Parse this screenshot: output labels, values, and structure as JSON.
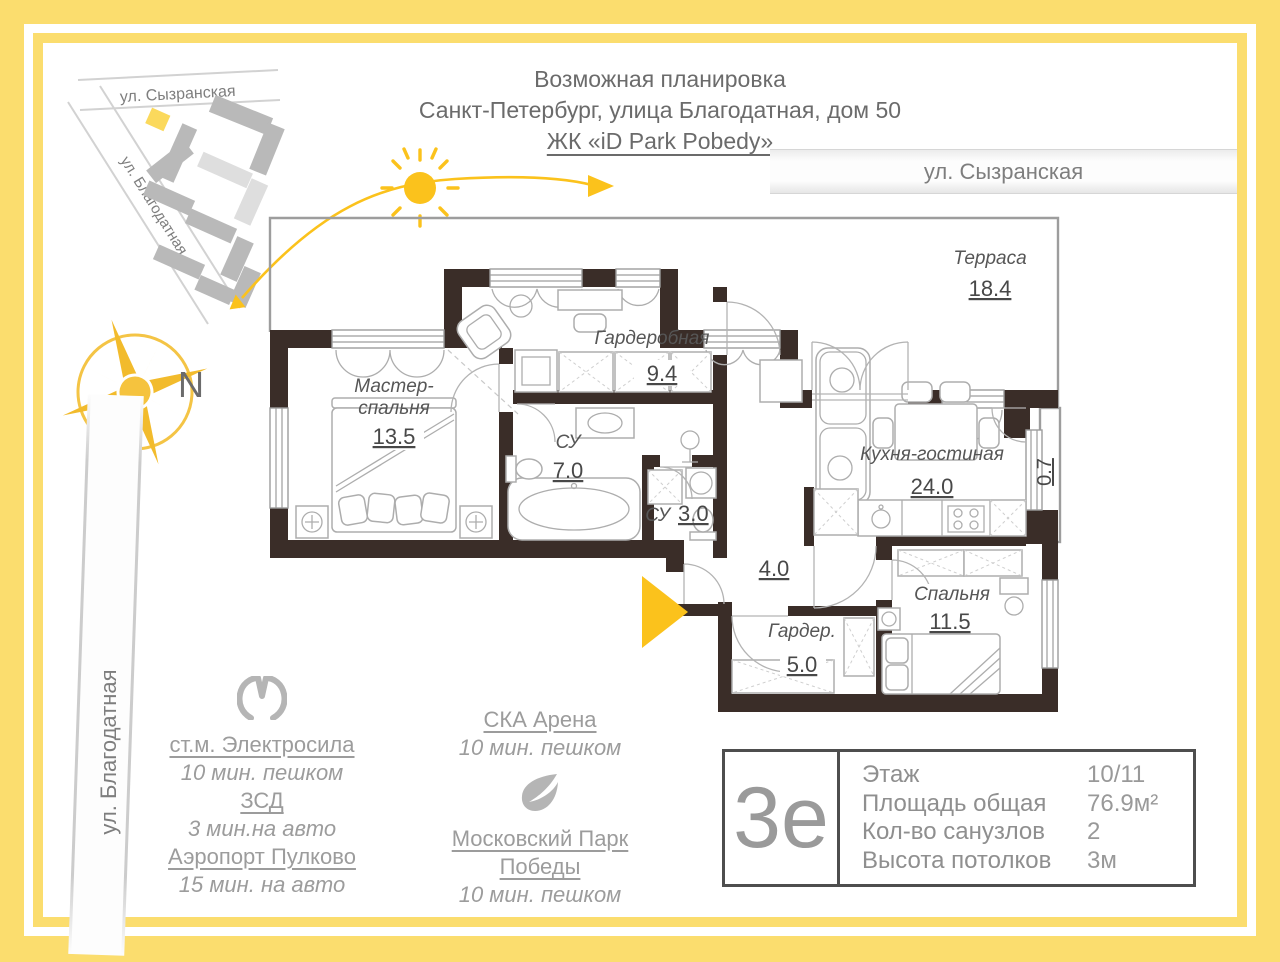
{
  "header": {
    "line1": "Возможная планировка",
    "line2": "Санкт-Петербург, улица Благодатная, дом 50",
    "complex": "ЖК «iD Park Pobedy»"
  },
  "map": {
    "street_top": "ул. Сызранская",
    "street_diagonal": "ул. Благодатная",
    "street_band_right": "ул. Сызранская",
    "street_vertical": "ул. Благодатная",
    "compass_north": "N"
  },
  "plan": {
    "terrace": {
      "name": "Терраса",
      "area": "18.4"
    },
    "wardrobe": {
      "name": "Гардеробная",
      "area": "9.4"
    },
    "master_bedroom": {
      "name_line1": "Мастер-",
      "name_line2": "спальня",
      "area": "13.5"
    },
    "bathroom_large": {
      "name": "СУ",
      "area": "7.0"
    },
    "bathroom_small": {
      "name": "СУ",
      "area": "3.0"
    },
    "kitchen_living": {
      "name": "Кухня-гостиная",
      "area": "24.0"
    },
    "bedroom": {
      "name": "Спальня",
      "area": "11.5"
    },
    "wardrobe_small": {
      "name": "Гардер.",
      "area": "5.0"
    },
    "hallway_area": "4.0",
    "balcony_area": "0.7"
  },
  "transport": {
    "metro_station": {
      "name": "ст.м. Электросила",
      "time": "10 мин. пешком"
    },
    "zsd": {
      "name": "ЗСД",
      "time": "3 мин.на авто"
    },
    "airport": {
      "name": "Аэропорт Пулково",
      "time": "15 мин. на авто"
    },
    "arena": {
      "name": "СКА Арена",
      "time": "10 мин. пешком"
    },
    "park": {
      "name_line1": "Московский Парк",
      "name_line2": "Победы",
      "time": "10 мин. пешком"
    }
  },
  "info_box": {
    "logo": "3е",
    "rows": [
      {
        "label": "Этаж",
        "value": "10/11"
      },
      {
        "label": "Площадь общая",
        "value": "76.9м²"
      },
      {
        "label": "Кол-во санузлов",
        "value": "2"
      },
      {
        "label": "Высота потолков",
        "value": "3м"
      }
    ]
  },
  "colors": {
    "frame_yellow": "#FBDD6E",
    "sun_yellow": "#FBC21C",
    "wall_dark": "#3A2D28",
    "gray_text": "#9B9B9B"
  }
}
